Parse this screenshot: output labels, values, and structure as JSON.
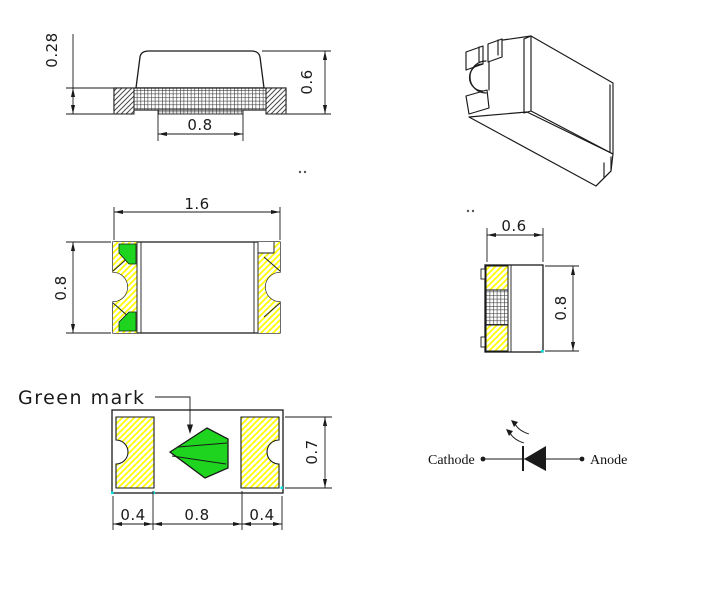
{
  "views": {
    "side": {
      "dim_pad_thickness": "0.28",
      "dim_total_height": "0.6",
      "dim_bottom_pad_width": "0.8"
    },
    "top": {
      "dim_length": "1.6",
      "dim_width": "0.8"
    },
    "end": {
      "dim_width": "0.6",
      "dim_height": "0.8"
    },
    "bottom": {
      "green_mark_label": "Green mark",
      "dim_left_pad": "0.4",
      "dim_center_gap": "0.8",
      "dim_right_pad": "0.4",
      "dim_pad_height": "0.7"
    },
    "schematic": {
      "cathode_label": "Cathode",
      "anode_label": "Anode"
    }
  },
  "colors": {
    "green_mark": "#1ed41e",
    "pad_hatch_yellow": "#ffff00",
    "line": "#1a1a1a",
    "cad_tick_cyan": "#00e6e6",
    "background": "#ffffff"
  }
}
